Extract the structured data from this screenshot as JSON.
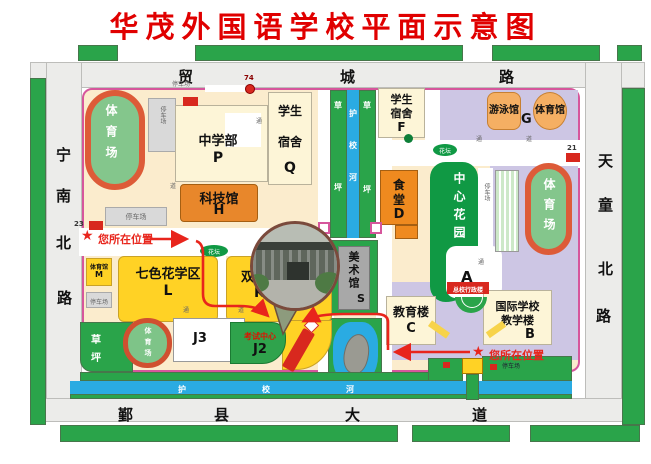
{
  "title": "华茂外国语学校平面示意图",
  "roads": {
    "top": {
      "name": "贸城路",
      "chars": [
        "贸",
        "城",
        "路"
      ]
    },
    "left": {
      "name": "宁南北路",
      "chars": [
        "宁",
        "南",
        "北",
        "路"
      ]
    },
    "right": {
      "name": "天童北路",
      "chars": [
        "天",
        "童",
        "北",
        "路"
      ]
    },
    "bottom": {
      "name": "鄞县大道",
      "chars": [
        "鄞",
        "县",
        "大",
        "道"
      ]
    }
  },
  "water": {
    "canal_name": "护校河",
    "canal_chars": [
      "护",
      "校",
      "河"
    ],
    "lawn_chars": [
      "草",
      "坪"
    ]
  },
  "buildings": {
    "stadium_nw": "体育场",
    "middle_school": {
      "name": "中学部",
      "letter": "P"
    },
    "dorm_q": {
      "l1": "学生",
      "l2": "宿舍",
      "letter": "Q"
    },
    "dorm_f": {
      "l1": "学生",
      "l2": "宿舍",
      "letter": "F"
    },
    "science": {
      "name": "科技馆",
      "letter": "H"
    },
    "swim": "游泳馆",
    "gym_ne": "体育馆",
    "g": "G",
    "canteen": {
      "c1": "食",
      "c2": "堂",
      "letter": "D"
    },
    "garden": "中心花园",
    "e": "E",
    "stadium_e": "体育场",
    "art": {
      "name": "美术馆",
      "letter": "S"
    },
    "edu": {
      "name": "教育楼",
      "letter": "C"
    },
    "intl": {
      "l1": "国际学校",
      "l2": "教学楼",
      "letter": "B"
    },
    "a": "A",
    "admin_box": "总校行政楼",
    "rainbow": {
      "name": "七色花学区",
      "letter": "L"
    },
    "bilingual": {
      "name": "双语",
      "letter": "K"
    },
    "gym_m": {
      "name": "体育馆",
      "letter": "M"
    },
    "lawn_sw": {
      "c1": "草",
      "c2": "坪"
    },
    "stadium_sw": "体育场",
    "j3": "J3",
    "exam": {
      "name": "考试中心",
      "letter": "J2"
    }
  },
  "markers": {
    "star": "★",
    "you_are_here": "您所在位置",
    "bus74": "74",
    "bus23": "23",
    "bus21": "21"
  },
  "labels": {
    "parking": "停车场",
    "flowerbed": "花坛",
    "tong": "通",
    "dao": "道"
  }
}
